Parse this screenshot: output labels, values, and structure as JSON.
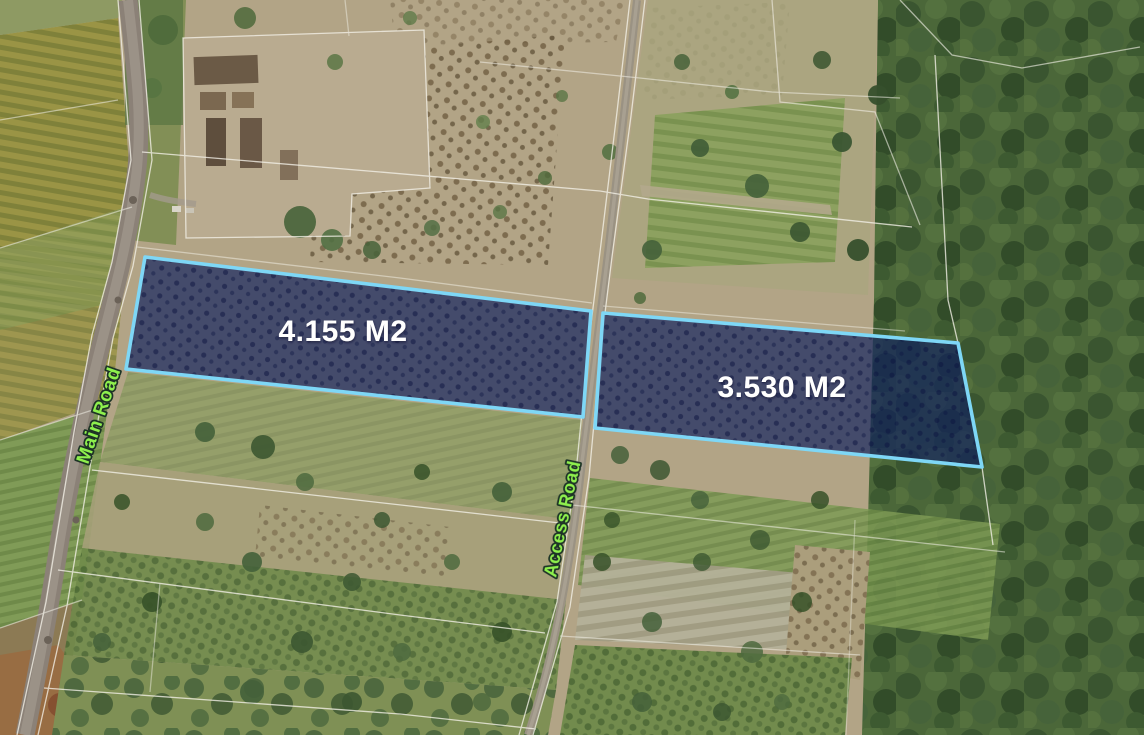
{
  "map": {
    "type": "satellite-annotated-land-listing",
    "parcels": [
      {
        "area_label": "4.155 M2",
        "fill": "#10205f",
        "outline": "#7ed7f6"
      },
      {
        "area_label": "3.530 M2",
        "fill": "#10205f",
        "outline": "#7ed7f6"
      }
    ],
    "roads": [
      {
        "label": "Main Road",
        "label_color": "#8ef04d"
      },
      {
        "label": "Access Road",
        "label_color": "#8ef04d"
      }
    ],
    "area_label_color": "#ffffff",
    "boundary_line_color": "#f4f1e8"
  }
}
